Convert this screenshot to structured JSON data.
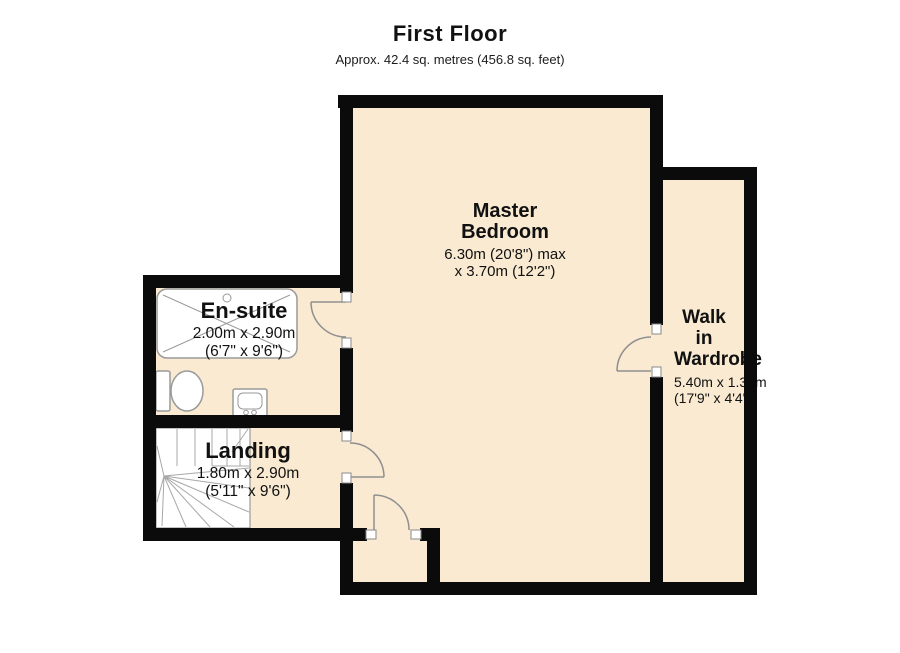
{
  "title": {
    "heading": "First Floor",
    "subtitle": "Approx. 42.4 sq. metres (456.8 sq. feet)"
  },
  "rooms": [
    {
      "name": "Master Bedroom",
      "dim1": "6.30m (20'8\") max",
      "dim2": "x 3.70m (12'2\")"
    },
    {
      "name": "En-suite",
      "dim1": "2.00m x 2.90m",
      "dim2": "(6'7\" x 9'6\")"
    },
    {
      "name": "Landing",
      "dim1": "1.80m x 2.90m",
      "dim2": "(5'11\" x 9'6\")"
    },
    {
      "name": "Walk in Wardrobe",
      "dim1": "5.40m x 1.33m",
      "dim2": "(17'9\" x 4'4\")"
    }
  ],
  "fixtures": [
    "shower-tray",
    "toilet",
    "wash-basin",
    "winder-staircase",
    "door-swing"
  ],
  "colors": {
    "floor": "#f9ead1",
    "wall": "#0b0b0b",
    "fixture_line": "#9a9a9a",
    "door_line": "#8f8f8f",
    "text": "#111111",
    "background": "#ffffff"
  }
}
